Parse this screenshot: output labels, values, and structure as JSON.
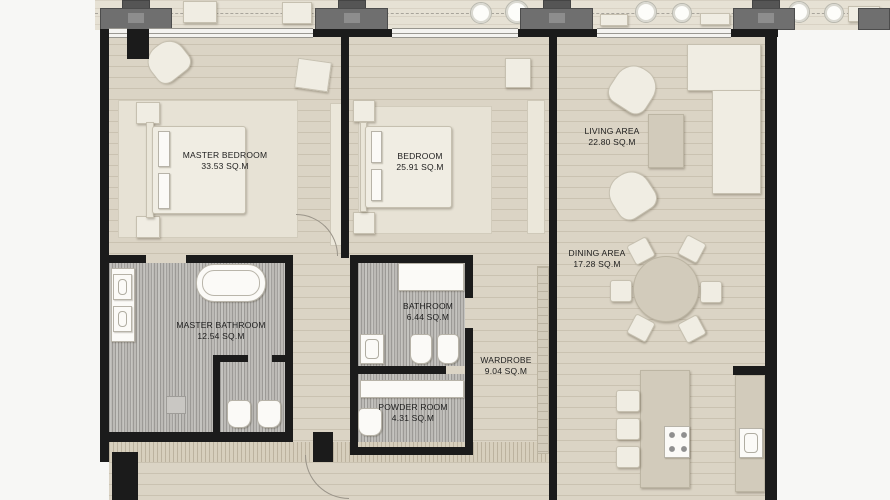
{
  "rooms": [
    {
      "name": "MASTER BEDROOM",
      "area": "33.53 SQ.M"
    },
    {
      "name": "BEDROOM",
      "area": "25.91 SQ.M"
    },
    {
      "name": "LIVING AREA",
      "area": "22.80 SQ.M"
    },
    {
      "name": "DINING AREA",
      "area": "17.28 SQ.M"
    },
    {
      "name": "MASTER BATHROOM",
      "area": "12.54 SQ.M"
    },
    {
      "name": "BATHROOM",
      "area": "6.44 SQ.M"
    },
    {
      "name": "WARDROBE",
      "area": "9.04 SQ.M"
    },
    {
      "name": "POWDER ROOM",
      "area": "4.31 SQ.M"
    }
  ],
  "colors": {
    "wall": "#1b1b1b",
    "floor_wood": "#dbd4c5",
    "floor_bathroom": "#bcbab6",
    "furniture": "#f0ede3",
    "furniture_dark": "#d2cbbb",
    "rug": "#e7e2d5",
    "column": "#6f6f6f",
    "balcony": "#e6e1d4",
    "background": "#f7f7f5"
  }
}
